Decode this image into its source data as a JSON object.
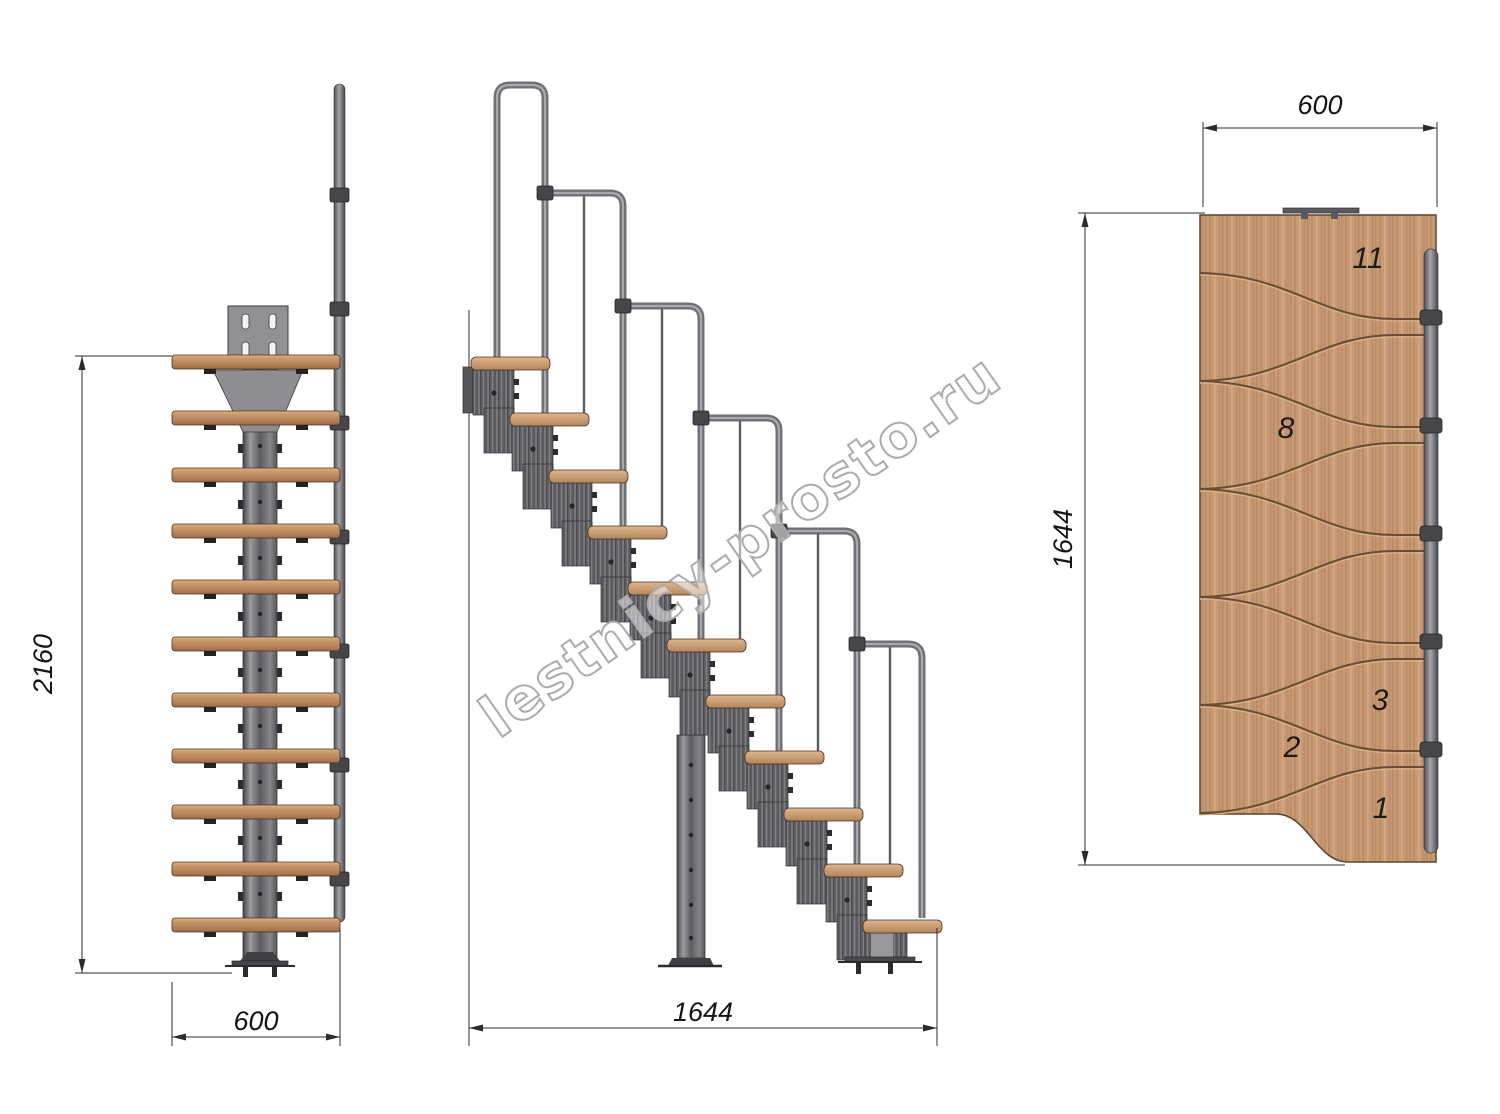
{
  "watermark": {
    "text": "lestnicy-prosto.ru"
  },
  "views": {
    "front": {
      "title": "front-elevation",
      "height_dim": "2160",
      "width_dim": "600"
    },
    "side": {
      "title": "side-elevation",
      "length_dim": "1644"
    },
    "plan": {
      "title": "top-plan",
      "width_dim": "600",
      "length_dim": "1644",
      "step_labels": [
        {
          "label": "11"
        },
        {
          "label": "8"
        },
        {
          "label": "3"
        },
        {
          "label": "2"
        },
        {
          "label": "1"
        }
      ]
    }
  },
  "colors": {
    "wood": "#c89a73",
    "metal": "#6e6e73",
    "dimension_line": "#2b2b2b",
    "watermark_outline": "#ababab"
  }
}
